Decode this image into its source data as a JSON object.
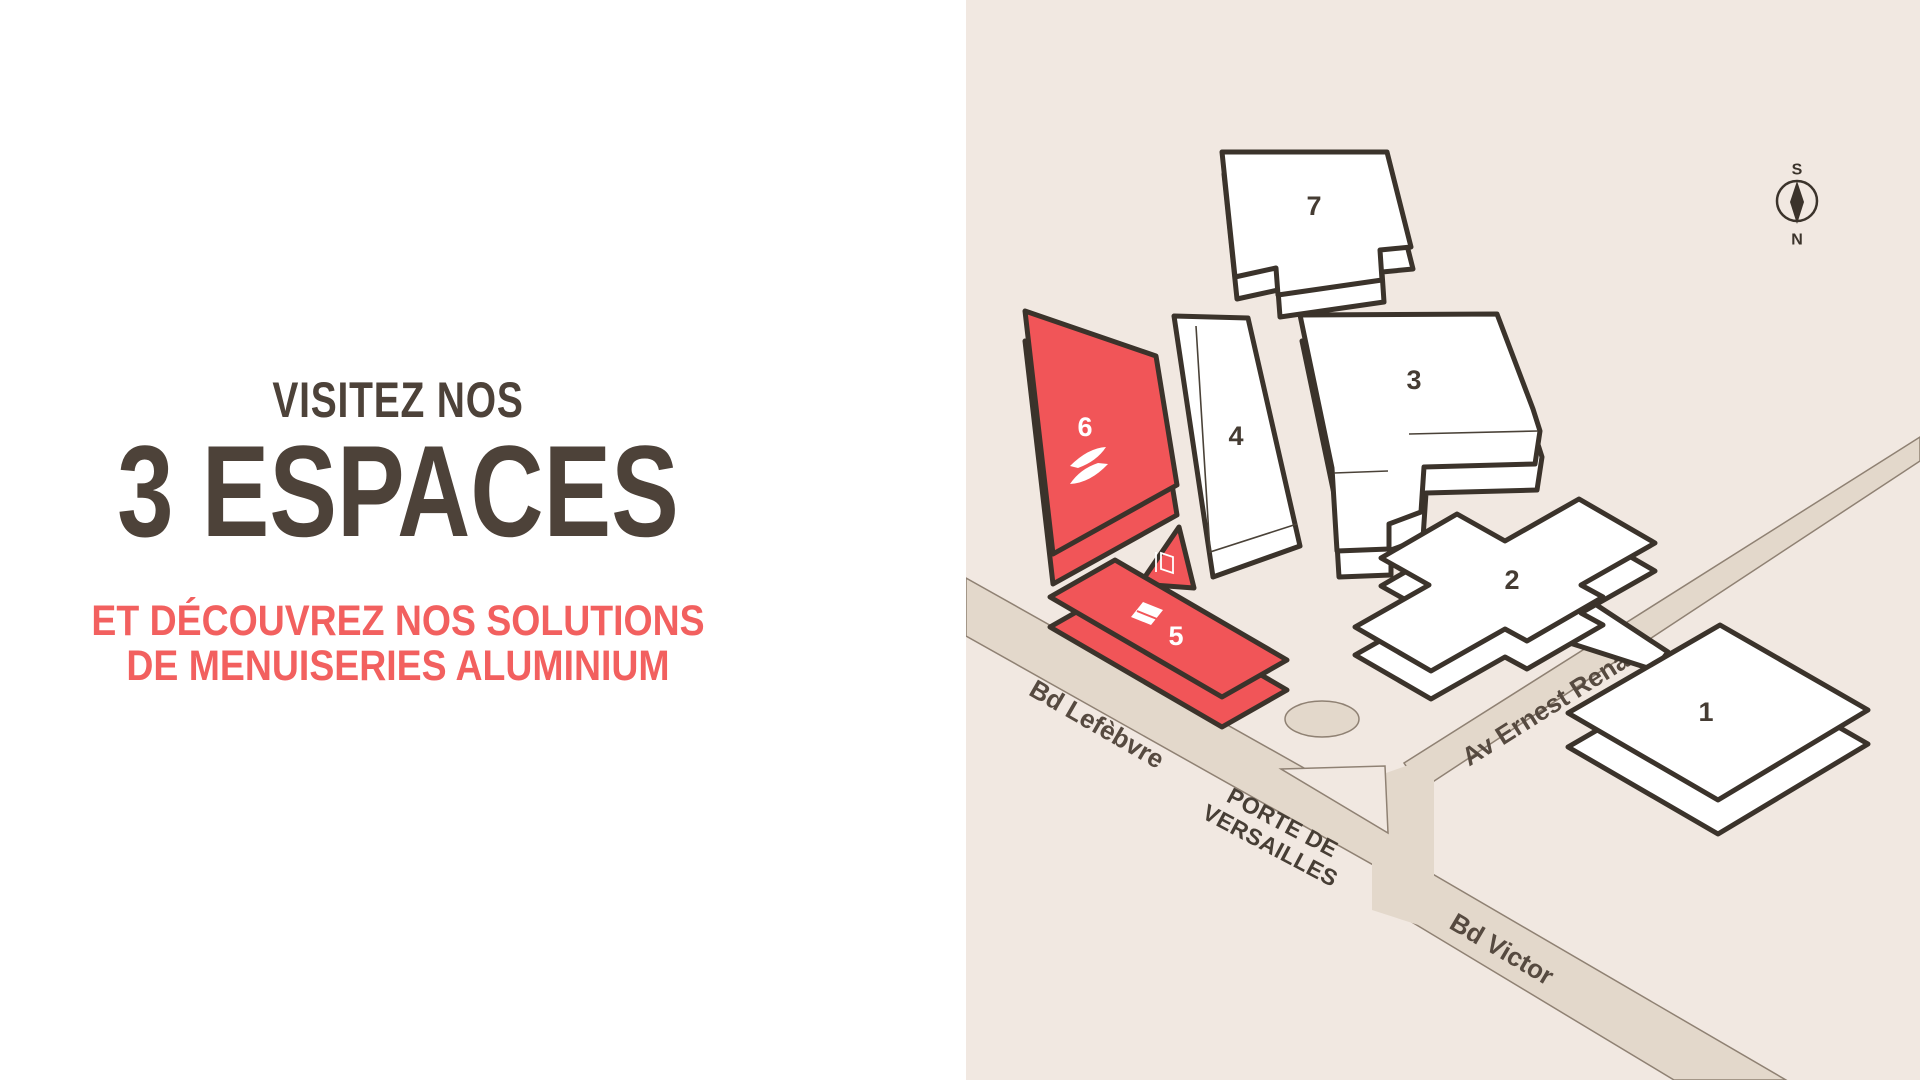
{
  "intro": {
    "title_line1": "VISITEZ NOS",
    "title_line2": "3 ESPACES",
    "subtitle_line1": "ET DÉCOUVREZ NOS SOLUTIONS",
    "subtitle_line2": "DE MENUISERIES ALUMINIUM",
    "title_color": "#4d4239",
    "subtitle_color": "#f2605f"
  },
  "map": {
    "background_color": "#f1e8e1",
    "road_color": "#e3d8cb",
    "outline_color": "#3b332b",
    "hall_fill_color": "#ffffff",
    "highlight_color": "#f15558",
    "compass": {
      "south": "S",
      "north": "N"
    },
    "streets": [
      {
        "name": "Bd Lefèbvre"
      },
      {
        "name": "Av Ernest Renan"
      },
      {
        "name": "Bd Victor"
      }
    ],
    "place": {
      "line1": "PORTE DE",
      "line2": "VERSAILLES"
    },
    "halls": [
      {
        "number": "1",
        "highlighted": false
      },
      {
        "number": "2",
        "highlighted": false
      },
      {
        "number": "3",
        "highlighted": false
      },
      {
        "number": "4",
        "highlighted": false
      },
      {
        "number": "5",
        "highlighted": true,
        "icon": "awning-icon"
      },
      {
        "number": "6",
        "highlighted": true,
        "icon": "swoosh-logo-icon"
      },
      {
        "number": "7",
        "highlighted": false
      }
    ],
    "kiosk": {
      "icon": "door-icon",
      "highlighted": true
    }
  }
}
